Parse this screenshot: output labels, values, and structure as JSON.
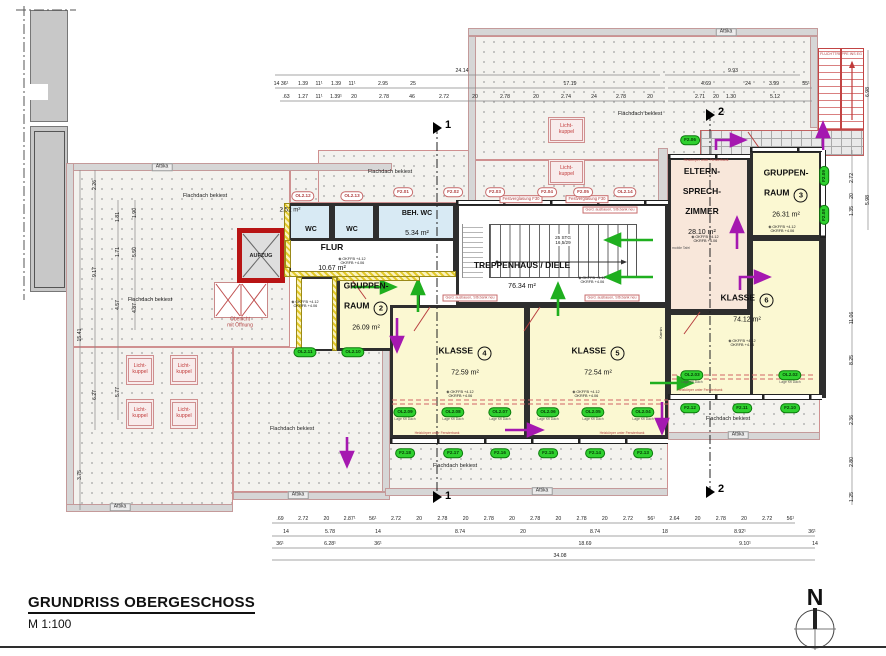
{
  "meta": {
    "title": "GRUNDRISS OBERGESCHOSS",
    "scale": "M 1:100",
    "north": "N"
  },
  "colors": {
    "escape_green": "#1faf1f",
    "escape_purple": "#a518b0",
    "wall": "#2e2e2e",
    "red_annotation": "#c03a3a",
    "roof_border": "#cf9090",
    "room_yellow": "#fbf8d2",
    "room_pink": "#f8e7da",
    "wc_blue": "#d8eaf4"
  },
  "rooms": {
    "wc_left": {
      "name": "WC"
    },
    "wc_right": {
      "name": "WC"
    },
    "beh_wc": {
      "name": "BEH. WC",
      "area": "5.34 m²"
    },
    "flur": {
      "name": "FLUR",
      "area": "10.67 m²"
    },
    "treppenhaus": {
      "name": "TREPPENHAUS / DIELE",
      "area": "76.34 m²"
    },
    "gruppenraum2": {
      "line1": "GRUPPEN-",
      "line2": "RAUM",
      "number": "2",
      "area": "26.09 m²"
    },
    "gruppenraum3": {
      "line1": "GRUPPEN-",
      "line2": "RAUM",
      "number": "3",
      "area": "26.31 m²"
    },
    "klasse4": {
      "name": "KLASSE",
      "number": "4",
      "area": "72.59 m²"
    },
    "klasse5": {
      "name": "KLASSE",
      "number": "5",
      "area": "72.54 m²"
    },
    "klasse6": {
      "name": "KLASSE",
      "number": "6",
      "area": "74.12 m²"
    },
    "eltern": {
      "line1": "ELTERN-",
      "line2": "SPRECH-",
      "line3": "ZIMMER",
      "area": "28.10 m²"
    },
    "aufzug": {
      "name": "AUFZUG"
    },
    "oberlicht": {
      "line1": "Oberlicht",
      "line2": "mit Öffnung"
    },
    "vorraum_area": "2.52 m²"
  },
  "stairs": {
    "count": "25 STG",
    "rise": "16,5/29"
  },
  "labels": {
    "flachdach": "Flachdach bekiest",
    "attika": "Attika",
    "lichtkuppel": "Licht- kuppel",
    "fluchttreppe": "FLUCHTTREPPE INS EG",
    "festverglasung": "Festverglasung F30",
    "heizkoerper": "Heizkörper unter Fensterbank",
    "bank": "Gerd. ausbauen, Stb.bank neu",
    "lage": "Lage Kfl Dach",
    "ok1": "OKFFB +4.12",
    "ok2": "OKRFB +4.06",
    "mobile_tafel": "mobile Tafel",
    "kamin": "Kamin"
  },
  "window_tags_red": [
    "OL2.12",
    "OL2.13",
    "F2.01",
    "F2.02",
    "F2.03",
    "F2.04",
    "F2.05",
    "OL2.14"
  ],
  "window_tags_green": [
    "OL2.11",
    "OL2.10",
    "OL2.09",
    "OL2.08",
    "OL2.07",
    "OL2.06",
    "OL2.05",
    "OL2.04",
    "OL2.03",
    "OL2.02",
    "F2.18",
    "F2.17",
    "F2.16",
    "F2.15",
    "F2.14",
    "F2.13",
    "F2.12",
    "F2.11",
    "F2.10",
    "F2.09",
    "F2.08",
    "F2.06"
  ],
  "dimensions": {
    "top_total": "24.14",
    "top_right_total": "9.93",
    "top_row2": [
      "14 36¹",
      "1.39",
      "11¹",
      "1.39",
      "11¹",
      "2.95",
      "25",
      "17.19"
    ],
    "top_row3": [
      ".63",
      "1.27",
      "11¹",
      "1.39¹",
      "20",
      "2.78",
      "46",
      "2.72",
      "20",
      "2.78",
      "20",
      "2.74",
      "24",
      "2.78",
      "20"
    ],
    "top_right_row2": [
      "4.69",
      "24",
      "3.99",
      "55¹"
    ],
    "top_right_row3": [
      "2.71",
      "20",
      "1.30",
      "5.12"
    ],
    "bottom_row1": [
      ".69",
      "2.72",
      "20",
      "2.87¹",
      "56¹",
      "2.72",
      "20",
      "2.78",
      "20",
      "2.78",
      "20",
      "2.78",
      "20",
      "2.78",
      "20",
      "2.72",
      "56¹",
      "2.64",
      "20",
      "2.78",
      "20",
      "2.72",
      "56¹"
    ],
    "bottom_row2": [
      "14",
      "5.78",
      "14",
      "8.74",
      "20",
      "8.74",
      "18",
      "8.92¹",
      "36¹"
    ],
    "bottom_row3": [
      "36¹",
      "6.28¹",
      "36¹",
      "18.69",
      "9.10¹",
      "14"
    ],
    "bottom_total": "34.08",
    "left": [
      "2.26",
      "1.81",
      "1.90",
      "1.71",
      "5.50",
      "9.17",
      "4.57",
      "4.87",
      "15.41",
      "6.27",
      "5.77",
      "3.75"
    ],
    "right": [
      "6.98",
      "2.72",
      "20",
      "1.35",
      "5.98",
      "11.06",
      "8.25",
      "2.36",
      "2.80",
      "1.25"
    ]
  },
  "sections": {
    "s1": "1",
    "s2": "2"
  }
}
